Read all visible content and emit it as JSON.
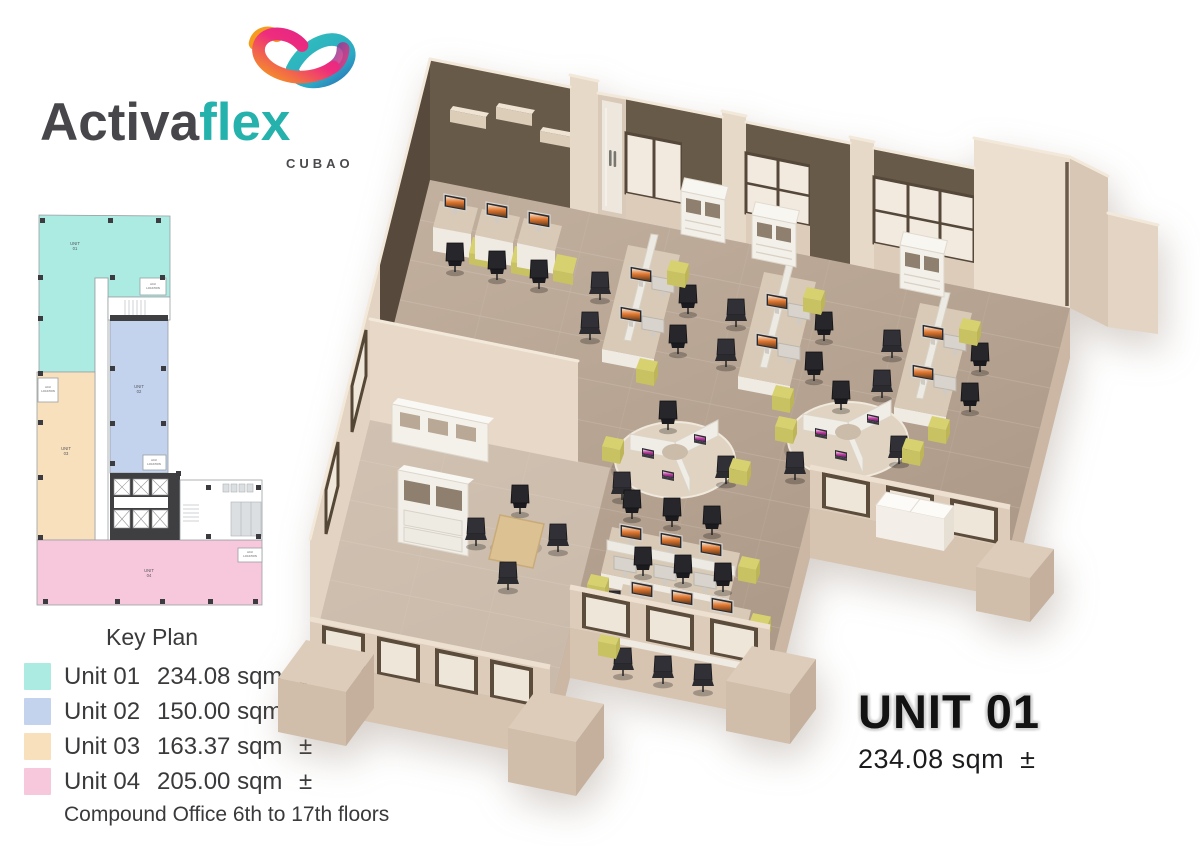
{
  "logo": {
    "brand_primary": "Activa",
    "brand_secondary": "flex",
    "location": "CUBAO"
  },
  "key_plan": {
    "title": "Key Plan",
    "note": "Compound Office 6th to 17th floors",
    "units": [
      {
        "label": "Unit 01",
        "area": "234.08 sqm",
        "tolerance": "±",
        "color": "#abebe2",
        "plan_label": "UNIT",
        "plan_number": "01"
      },
      {
        "label": "Unit 02",
        "area": "150.00 sqm",
        "tolerance": "±",
        "color": "#c3d3ee",
        "plan_label": "UNIT",
        "plan_number": "02"
      },
      {
        "label": "Unit 03",
        "area": "163.37 sqm",
        "tolerance": "±",
        "color": "#f9e0bd",
        "plan_label": "UNIT",
        "plan_number": "03"
      },
      {
        "label": "Unit 04",
        "area": "205.00 sqm",
        "tolerance": "±",
        "color": "#f7c7db",
        "plan_label": "UNIT",
        "plan_number": "04"
      }
    ],
    "location_label": [
      "ACU",
      "LOCATION"
    ]
  },
  "unit_detail": {
    "name": "UNIT 01",
    "area": "234.08 sqm",
    "tolerance": "±"
  }
}
